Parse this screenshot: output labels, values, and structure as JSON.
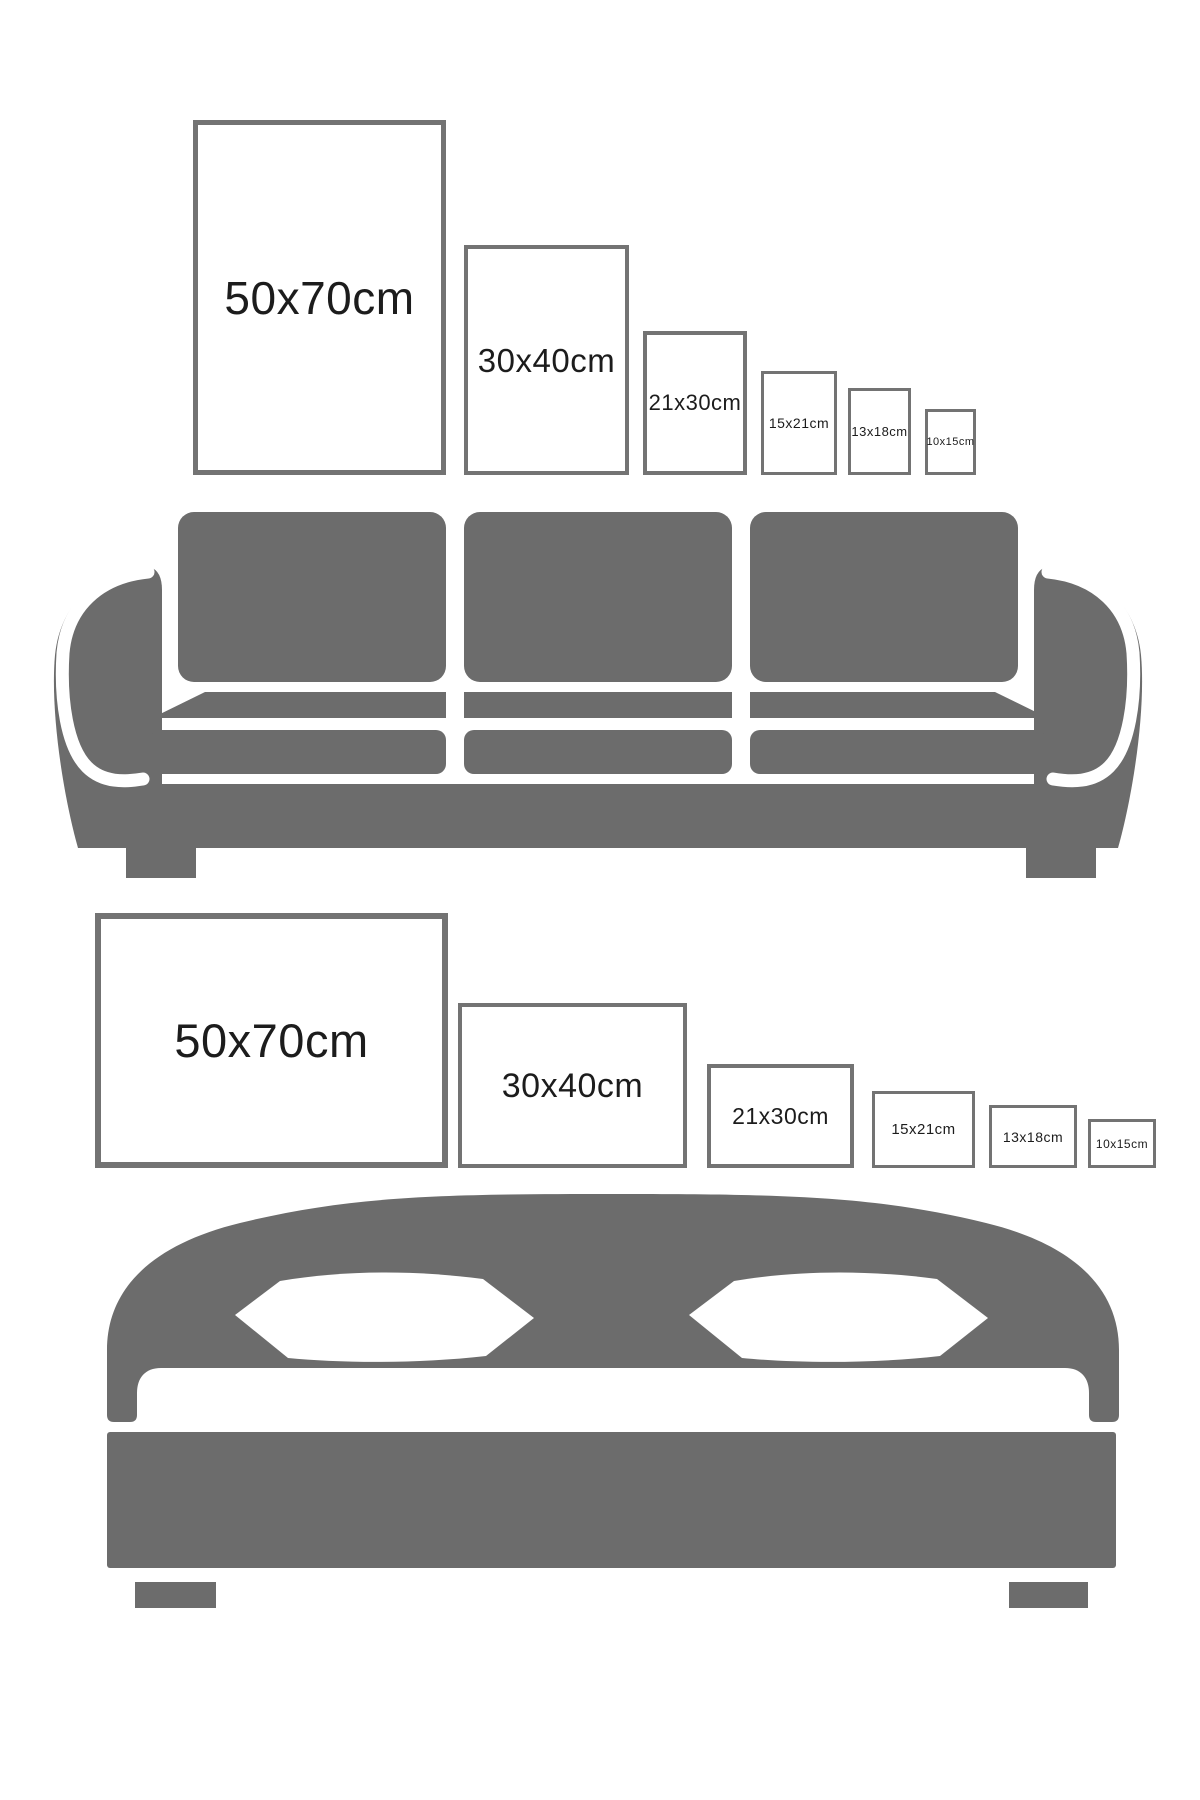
{
  "title": "Picture frame size comparison guide",
  "colors": {
    "background": "#ffffff",
    "furniture": "#6c6c6c",
    "frame_border": "#737373",
    "frame_fill": "#ffffff",
    "label_text": "#1c1c1c"
  },
  "sections": [
    {
      "id": "portrait-row",
      "furniture": "sofa",
      "orientation": "portrait",
      "frames": [
        {
          "label": "50x70cm",
          "x": 193,
          "y": 120,
          "w": 253,
          "h": 355,
          "border": 5,
          "font": 46
        },
        {
          "label": "30x40cm",
          "x": 464,
          "y": 245,
          "w": 165,
          "h": 230,
          "border": 4,
          "font": 33
        },
        {
          "label": "21x30cm",
          "x": 643,
          "y": 331,
          "w": 104,
          "h": 144,
          "border": 4,
          "font": 22
        },
        {
          "label": "15x21cm",
          "x": 761,
          "y": 371,
          "w": 76,
          "h": 104,
          "border": 3,
          "font": 14
        },
        {
          "label": "13x18cm",
          "x": 848,
          "y": 388,
          "w": 63,
          "h": 87,
          "border": 3,
          "font": 13
        },
        {
          "label": "10x15cm",
          "x": 925,
          "y": 409,
          "w": 51,
          "h": 66,
          "border": 3,
          "font": 11
        }
      ]
    },
    {
      "id": "landscape-row",
      "furniture": "bed",
      "orientation": "landscape",
      "frames": [
        {
          "label": "50x70cm",
          "x": 95,
          "y": 913,
          "w": 353,
          "h": 255,
          "border": 6,
          "font": 47
        },
        {
          "label": "30x40cm",
          "x": 458,
          "y": 1003,
          "w": 229,
          "h": 165,
          "border": 4,
          "font": 34
        },
        {
          "label": "21x30cm",
          "x": 707,
          "y": 1064,
          "w": 147,
          "h": 104,
          "border": 4,
          "font": 23
        },
        {
          "label": "15x21cm",
          "x": 872,
          "y": 1091,
          "w": 103,
          "h": 77,
          "border": 3,
          "font": 15
        },
        {
          "label": "13x18cm",
          "x": 989,
          "y": 1105,
          "w": 88,
          "h": 63,
          "border": 3,
          "font": 14
        },
        {
          "label": "10x15cm",
          "x": 1088,
          "y": 1119,
          "w": 68,
          "h": 49,
          "border": 3,
          "font": 12
        }
      ]
    }
  ]
}
